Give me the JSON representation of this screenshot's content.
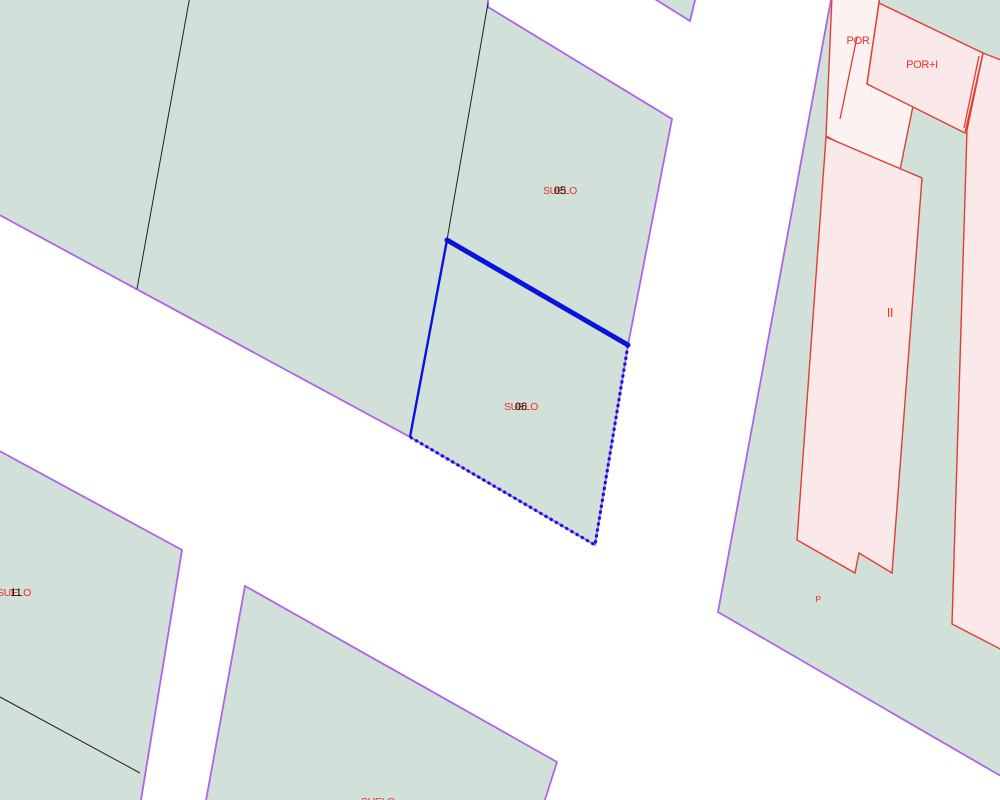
{
  "map": {
    "type": "cadastral-parcel-map",
    "selection": {
      "selected_parcel_number": "06",
      "highlight_color": "#0b12dd"
    },
    "colors": {
      "background": "#ffffff",
      "parcel_fill": "#d2e0da",
      "parcel_border": "#af64e6",
      "building_fill": "#fae9e8",
      "building_fill_light": "#fdf2f2",
      "building_border": "#e23c34",
      "subdivision_line": "#222222",
      "label_red": "#ef2d26",
      "label_black": "#111111",
      "selection_blue": "#0b12dd"
    },
    "labels": {
      "parcel05": {
        "text": "SUELO",
        "number": "05"
      },
      "parcel06": {
        "text": "SUELO",
        "number": "06"
      },
      "parcel_left": {
        "text": "SUELO",
        "number": "11"
      },
      "parcel_bottom": {
        "text": "SUELO",
        "number": ""
      },
      "por": {
        "text": "POR"
      },
      "por_plus_i": {
        "text": "POR+I"
      },
      "building_ii": {
        "text": "II"
      },
      "patio": {
        "text": "P"
      }
    }
  }
}
